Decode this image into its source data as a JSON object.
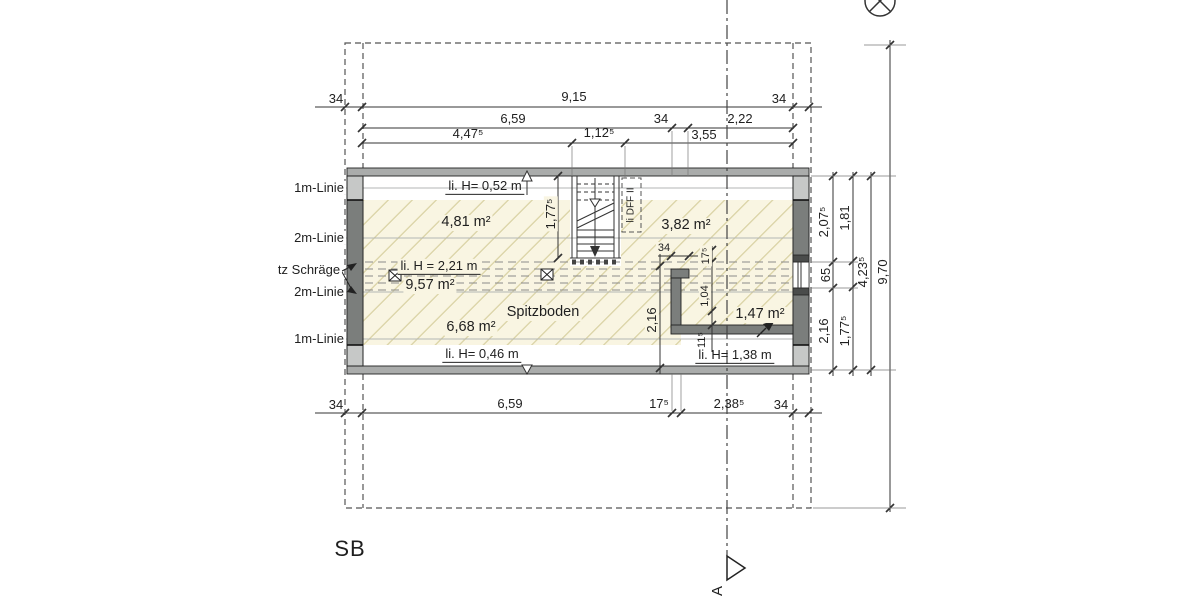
{
  "sheet": {
    "label": "SB"
  },
  "section": {
    "letter": "A"
  },
  "annotations": {
    "left": [
      "1m-Linie",
      "2m-Linie",
      "tz Schräge",
      "2m-Linie",
      "1m-Linie"
    ],
    "room_name": "Spitzboden",
    "roof_window_label": "li DFF II"
  },
  "areas": {
    "a1": "4,81 m²",
    "a2": "3,82 m²",
    "a3": "9,57 m²",
    "a4": "6,68 m²",
    "a5": "1,47 m²"
  },
  "heights": {
    "top": "li. H= 0,52 m",
    "middle": "li. H = 2,21 m",
    "bottom": "li. H= 0,46 m",
    "right": "li. H= 1,38 m"
  },
  "dimensions": {
    "top_row1": [
      "34",
      "9,15",
      "34"
    ],
    "top_row2": [
      "6,59",
      "34",
      "2,22"
    ],
    "top_row3": [
      "4,47⁵",
      "1,12⁵",
      "3,55"
    ],
    "bottom_row": [
      "34",
      "6,59",
      "17⁵",
      "2,38⁵",
      "34"
    ],
    "right_chain_inner": [
      "2,07⁵",
      "65",
      "2,16"
    ],
    "right_chain_outer": [
      "1,81",
      "1,77⁵"
    ],
    "right_total_inner": "4,23⁵",
    "right_total": "9,70",
    "stair_length": "1,77⁵",
    "room_depth": "2,16",
    "wall_flange": "34",
    "wall_chain": [
      "17⁵",
      "1,04",
      "11⁵"
    ]
  },
  "colors": {
    "wall_dark": "#7b7e7c",
    "wall_light": "#c6c8c7",
    "wall_band": "#aaacab",
    "hatch_bg": "#f9f5e2",
    "hatch_line": "#ddd6ab"
  }
}
